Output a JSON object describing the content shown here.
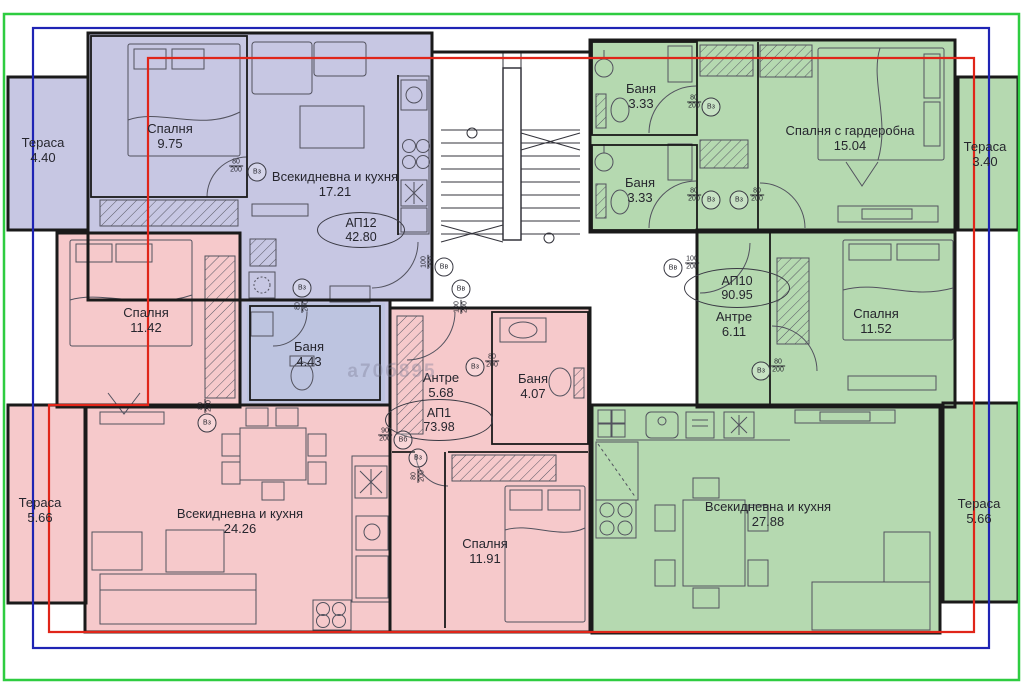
{
  "colors": {
    "apartment_purple": "#c7c7e3",
    "apartment_pink": "#f6c9cb",
    "apartment_green": "#b5d9b0",
    "bath_blue": "#bdc4e0",
    "wall_black": "#1a1a1a",
    "frame_green": "#2ecc40",
    "frame_blue": "#1f24b4",
    "frame_red": "#e02519"
  },
  "apartments": [
    {
      "id": "ap12",
      "label": "АП12",
      "area": "42.80"
    },
    {
      "id": "ap1",
      "label": "АП1",
      "area": "73.98"
    },
    {
      "id": "ap10",
      "label": "АП10",
      "area": "90.95"
    }
  ],
  "rooms": [
    {
      "name": "Спалня",
      "area": "9.75"
    },
    {
      "name": "Всекидневна и кухня",
      "area": "17.21"
    },
    {
      "name": "Баня",
      "area": "4.43"
    },
    {
      "name": "Спалня",
      "area": "11.42"
    },
    {
      "name": "Всекидневна и кухня",
      "area": "24.26"
    },
    {
      "name": "Антре",
      "area": "5.68"
    },
    {
      "name": "Баня",
      "area": "4.07"
    },
    {
      "name": "Спалня",
      "area": "11.91"
    },
    {
      "name": "Баня",
      "area": "3.33"
    },
    {
      "name": "Баня",
      "area": "3.33"
    },
    {
      "name": "Спалня с гардеробна",
      "area": "15.04"
    },
    {
      "name": "Спалня",
      "area": "11.52"
    },
    {
      "name": "Антре",
      "area": "6.11"
    },
    {
      "name": "Всекидневна и кухня",
      "area": "27.88"
    }
  ],
  "terraces": [
    {
      "name": "Тераса",
      "area": "4.40"
    },
    {
      "name": "Тераса",
      "area": "5.66"
    },
    {
      "name": "Тераса",
      "area": "3.40"
    },
    {
      "name": "Тераса",
      "area": "5.66"
    }
  ],
  "door_marks": [
    {
      "label": "Вз",
      "width": "80",
      "height": "200"
    },
    {
      "label": "Вз",
      "width": "80",
      "height": "200"
    },
    {
      "label": "Вв",
      "width": "100",
      "height": "200"
    },
    {
      "label": "Вв",
      "width": "100",
      "height": "200"
    },
    {
      "label": "Вв",
      "width": "100",
      "height": "200"
    },
    {
      "label": "Вз",
      "width": "80",
      "height": "200"
    },
    {
      "label": "Вз",
      "width": "80",
      "height": "200"
    },
    {
      "label": "Вз",
      "width": "80",
      "height": "200"
    },
    {
      "label": "Вз",
      "width": "80",
      "height": "200"
    },
    {
      "label": "Вб",
      "width": "90",
      "height": "200"
    },
    {
      "label": "Вз",
      "width": "80",
      "height": "200"
    },
    {
      "label": "Вз",
      "width": "80",
      "height": "200"
    },
    {
      "label": "Вз",
      "width": "80",
      "height": "200"
    }
  ],
  "watermark": "а70б895"
}
